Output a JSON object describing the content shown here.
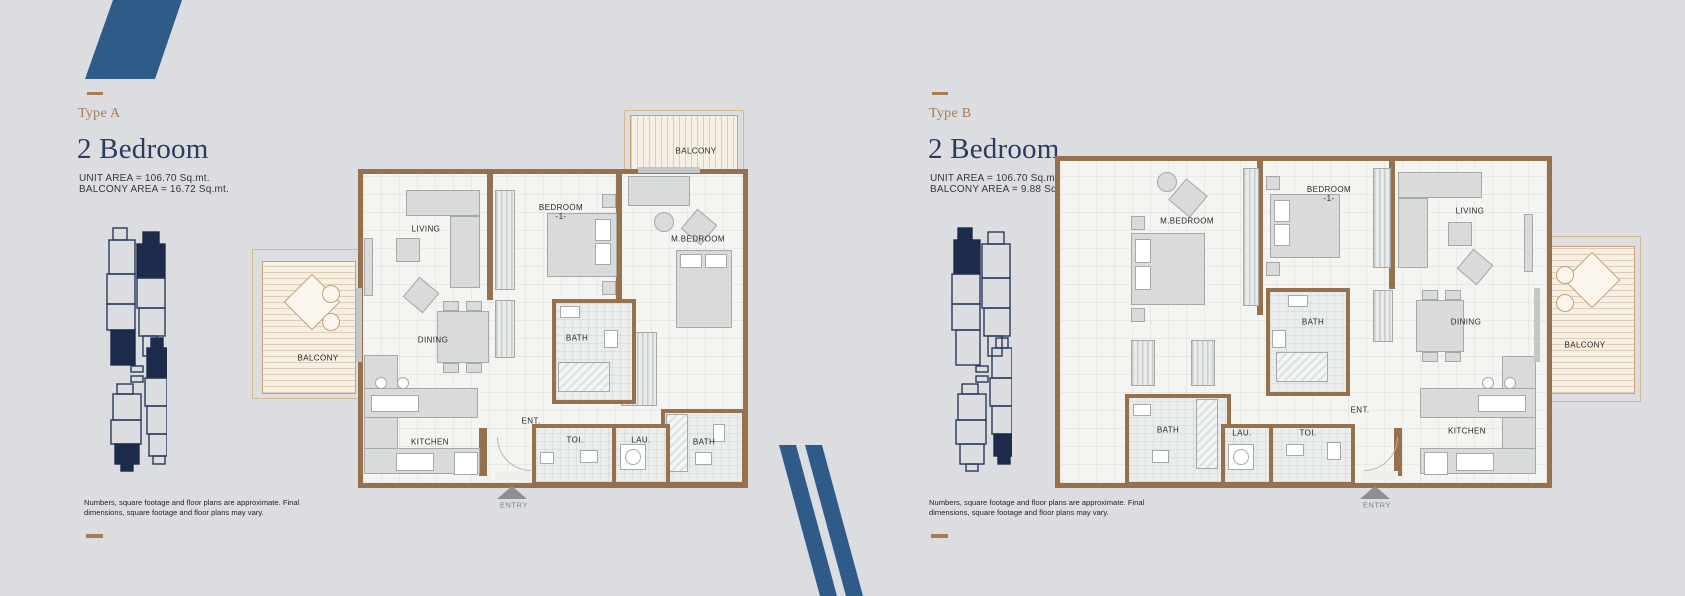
{
  "page": {
    "background": "#dcdde1",
    "accent_blue": "#2e5b87",
    "navy": "#1d2b4b",
    "gold": "#a97c50",
    "wall_brown": "#96714d"
  },
  "panels": [
    {
      "type_label": "Type A",
      "title": "2 Bedroom",
      "unit_area": "UNIT AREA = 106.70 Sq.mt.",
      "balcony_area": "BALCONY AREA = 16.72 Sq.mt.",
      "disclaimer": "Numbers, square footage and floor plans are approximate. Final\ndimensions, square footage and floor plans may vary.",
      "entry_label": "ENTRY",
      "rooms": {
        "balcony_top": "BALCONY",
        "balcony_side": "BALCONY",
        "living": "LIVING",
        "bedroom1_line1": "BEDROOM",
        "bedroom1_line2": "-1-",
        "master_bedroom": "M.BEDROOM",
        "dining": "DINING",
        "bath": "BATH",
        "bath2": "BATH",
        "kitchen": "KITCHEN",
        "entrance": "ENT.",
        "toilet": "TOI.",
        "laundry": "LAU."
      }
    },
    {
      "type_label": "Type B",
      "title": "2 Bedroom",
      "unit_area": "UNIT AREA = 106.70 Sq.mt.",
      "balcony_area": "BALCONY AREA = 9.88 Sq.mt.",
      "disclaimer": "Numbers, square footage and floor plans are approximate. Final\ndimensions, square footage and floor plans may vary.",
      "entry_label": "ENTRY",
      "rooms": {
        "balcony_side": "BALCONY",
        "living": "LIVING",
        "bedroom1_line1": "BEDROOM",
        "bedroom1_line2": "-1-",
        "master_bedroom": "M.BEDROOM",
        "dining": "DINING",
        "bath": "BATH",
        "bath2": "BATH",
        "kitchen": "KITCHEN",
        "entrance": "ENT.",
        "toilet": "TOI.",
        "laundry": "LAU."
      }
    }
  ]
}
